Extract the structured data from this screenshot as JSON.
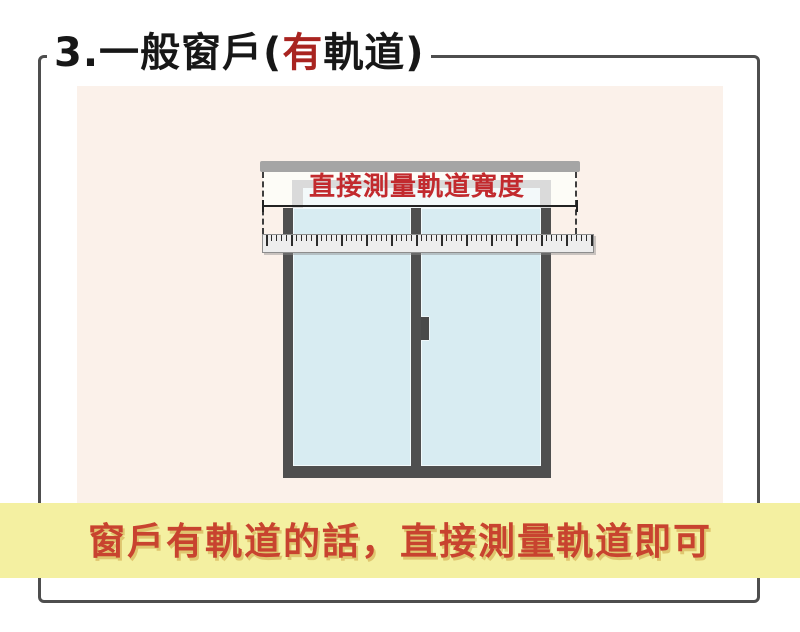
{
  "page": {
    "title": {
      "prefix": "3.一般窗戶(",
      "highlight": "有",
      "suffix": "軌道)"
    },
    "illustration": {
      "track_width_label": "直接測量軌道寬度"
    },
    "caption": "窗戶有軌道的話，直接測量軌道即可",
    "colors": {
      "accent_red": "#c22a2e",
      "title_highlight_red": "#a92420",
      "caption_red": "#c8432f",
      "banner_yellow": "#f4f0a1",
      "canvas_pink": "#fbf1ea",
      "pane_blue": "#d8ecf2",
      "window_frame_gray": "#4f4f4f",
      "track_gray": "#a5a5a5",
      "ruler_gray": "#ededed"
    }
  }
}
